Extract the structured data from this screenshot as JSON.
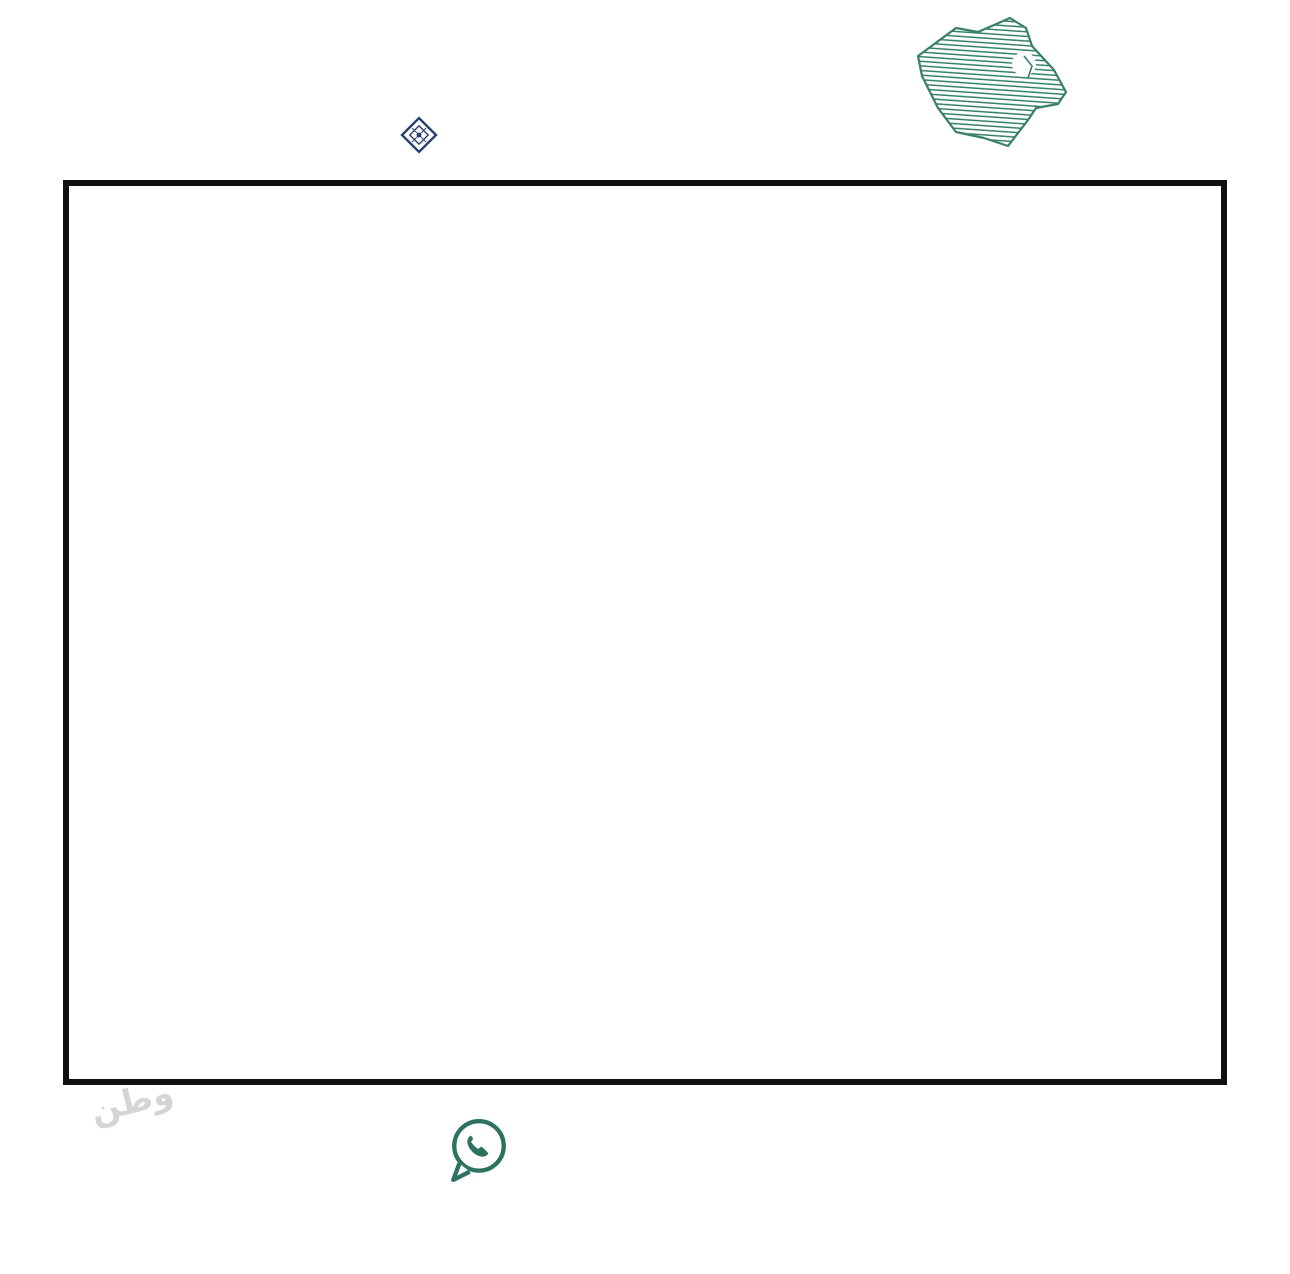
{
  "colors": {
    "green": "#37806b",
    "green2": "#2d7260",
    "navy": "#27406e",
    "red": "#c9281c",
    "qr_green": "#4c8873",
    "line": "#1b1b1b",
    "watermark": "#6aa591"
  },
  "header": {
    "license_number": "1200008850",
    "classification_number": "658",
    "fal_en": "FAL",
    "fal_ar": "فال",
    "fal_sub": "رخصة",
    "authority_ar": "الهيئة العامة للعقار",
    "authority_en": "REAL ESTATE GENERAL AUTHORITY",
    "authority_sub": "تصنيف المنشآت العقارية"
  },
  "brand": {
    "name_ar": "وطن للعقار",
    "name_en": "WATAN REAL ESTATE",
    "side_word": "شمعة"
  },
  "footer": {
    "phone": "0508505505",
    "website": "watanaqar.com"
  },
  "map": {
    "highlight_plot": "٣٣٧",
    "district_label": "الحي الخامس",
    "facility_label": "(٩)",
    "highlight": {
      "cx": 686,
      "cy": 401,
      "rx": 32,
      "ry": 25,
      "rot": -8,
      "stroke_width": 7.5
    },
    "scanline_y": 620,
    "noise_count": 300,
    "blocks": [
      {
        "x": 28,
        "y": 452,
        "rot": -33,
        "rows": 2,
        "cols": 5,
        "cw": 47,
        "ch": 27,
        "start": 479
      },
      {
        "x": 185,
        "y": 352,
        "rot": -26,
        "rows": 2,
        "cols": 5,
        "cw": 47,
        "ch": 27,
        "start": 469
      },
      {
        "x": 342,
        "y": 264,
        "rot": -18,
        "rows": 2,
        "cols": 5,
        "cw": 47,
        "ch": 27,
        "start": 459
      },
      {
        "x": 512,
        "y": 198,
        "rot": -11,
        "rows": 2,
        "cols": 6,
        "cw": 47,
        "ch": 27,
        "start": 449
      },
      {
        "x": 745,
        "y": 150,
        "rot": -5,
        "rows": 2,
        "cols": 4,
        "cw": 47,
        "ch": 27,
        "start": 437
      },
      {
        "x": 955,
        "y": 58,
        "rot": -40,
        "rows": 2,
        "cols": 4,
        "cw": 46,
        "ch": 27,
        "start": 153
      },
      {
        "x": 1022,
        "y": 262,
        "rot": -40,
        "rows": 2,
        "cols": 5,
        "cw": 46,
        "ch": 27,
        "start": 191
      },
      {
        "x": 120,
        "y": 396,
        "rot": 9,
        "rows": 2,
        "cols": 8,
        "cw": 50,
        "ch": 28,
        "start": 261
      },
      {
        "x": 560,
        "y": 366,
        "rot": 9,
        "rows": 2,
        "cols": 8,
        "cw": 52,
        "ch": 28,
        "start": 341
      },
      {
        "x": 1020,
        "y": 438,
        "rot": 9,
        "rows": 2,
        "cols": 3,
        "cw": 50,
        "ch": 28,
        "start": 325
      },
      {
        "x": 90,
        "y": 486,
        "rot": 9,
        "rows": 2,
        "cols": 7,
        "cw": 50,
        "ch": 28,
        "start": 419
      },
      {
        "x": 478,
        "y": 538,
        "rot": 9,
        "rows": 2,
        "cols": 6,
        "cw": 50,
        "ch": 28,
        "start": 293
      },
      {
        "x": 30,
        "y": 584,
        "rot": 9,
        "rows": 2,
        "cols": 7,
        "cw": 50,
        "ch": 28,
        "start": 445
      },
      {
        "x": 705,
        "y": 602,
        "rot": 9,
        "rows": 2,
        "cols": 4,
        "cw": 50,
        "ch": 28,
        "start": 371
      },
      {
        "x": 55,
        "y": 692,
        "rot": 9,
        "rows": 2,
        "cols": 7,
        "cw": 50,
        "ch": 28,
        "start": 489
      },
      {
        "x": 48,
        "y": 790,
        "rot": 9,
        "rows": 2,
        "cols": 7,
        "cw": 50,
        "ch": 28,
        "start": 199
      },
      {
        "x": 465,
        "y": 806,
        "rot": 9,
        "rows": 2,
        "cols": 3,
        "cw": 46,
        "ch": 28,
        "start": 143
      },
      {
        "x": 950,
        "y": 640,
        "rot": 37,
        "rows": 2,
        "cols": 6,
        "cw": 46,
        "ch": 27,
        "start": 121
      },
      {
        "x": 62,
        "y": 874,
        "rot": 9,
        "rows": 1,
        "cols": 6,
        "cw": 50,
        "ch": 26,
        "start": 563
      },
      {
        "x": 952,
        "y": 842,
        "rot": 9,
        "rows": 1,
        "cols": 4,
        "cw": 50,
        "ch": 26,
        "start": 535
      }
    ],
    "special_blocks": [
      {
        "x": 868,
        "y": 152,
        "rot": -5,
        "w": 150,
        "h": 96,
        "scribble": true
      },
      {
        "x": 432,
        "y": 718,
        "rot": 9,
        "w": 115,
        "h": 55,
        "scribble": true
      },
      {
        "x": 598,
        "y": 738,
        "rot": 9,
        "w": 290,
        "h": 112,
        "label_key": "district_label",
        "label_size": 21,
        "scribble": true
      },
      {
        "x": 832,
        "y": 492,
        "rot": 9,
        "w": 130,
        "h": 86,
        "label_key": "facility_label",
        "label_size": 15,
        "scribble": true
      }
    ],
    "roads": [
      "M 845,-25 C 560,108 235,300 -25,562",
      "M 863,-8 C 578,125 253,317 -7,579",
      "M 556,330 L 1172,428",
      "M 556,344 L 1172,442",
      "M -20,443 L 1172,631",
      "M -20,457 L 1172,645",
      "M -20,540 L 640,641",
      "M -20,553 L 640,654",
      "M -20,630 L 1172,818",
      "M -20,643 L 1172,831",
      "M -20,762 L 430,830",
      "M -20,774 L 430,842",
      "M 492,348 L 430,893",
      "M 508,350 L 446,893",
      "M 906,-25 L 1038,342 L 956,600 L 900,893",
      "M 923,-28 L 1055,339 L 973,597 L 917,893"
    ],
    "dashed": [
      "M 10,455 L 640,556",
      "M 240,690 L 900,794",
      "M -10,545 L 210,368"
    ],
    "fragments": [
      {
        "d": "M 85,175 L 105,160 L 215,112",
        "dash": true
      },
      {
        "d": "M 140,163 L 250,118"
      },
      {
        "d": "M 240,78 L 252,92 L 292,83"
      },
      {
        "d": "M 430,60 L 520,54",
        "dash": true
      },
      {
        "d": "M 640,25 L 700,60"
      },
      {
        "d": "M 1040,28 L 1120,20"
      }
    ],
    "watermarks": [
      {
        "text": "وطن للعقار",
        "x": 60,
        "y": 40,
        "rot": -16,
        "size": 34
      },
      {
        "text": "WATAN REAL ESTATE",
        "x": 120,
        "y": 70,
        "rot": -16,
        "size": 12
      },
      {
        "text": "وطن للعقار",
        "x": 640,
        "y": 38,
        "rot": -8,
        "size": 28
      },
      {
        "text": "WATAN REAL ESTATE",
        "x": 1128,
        "y": 400,
        "rot": 90,
        "size": 18
      },
      {
        "text": "وطن للعقار",
        "x": 40,
        "y": 846,
        "rot": -16,
        "size": 30
      },
      {
        "text": "العقار وطن",
        "x": 520,
        "y": 882,
        "rot": -10,
        "size": 26
      }
    ]
  }
}
